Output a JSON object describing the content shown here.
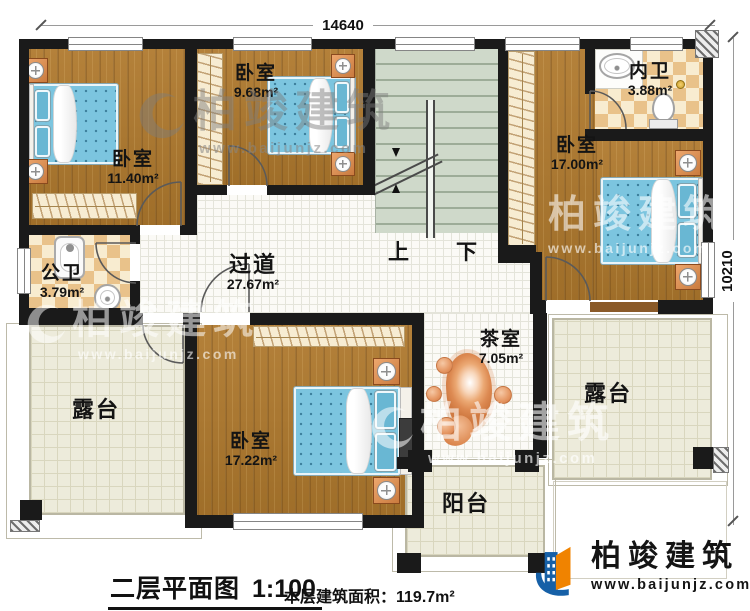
{
  "dimensions": {
    "width": "14640",
    "height": "10210"
  },
  "rooms": {
    "bedroom_tl": {
      "name": "卧室",
      "area": "11.40m²"
    },
    "bedroom_tm": {
      "name": "卧室",
      "area": "9.68m²"
    },
    "bedroom_right": {
      "name": "卧室",
      "area": "17.00m²"
    },
    "bedroom_bottom": {
      "name": "卧室",
      "area": "17.22m²"
    },
    "inner_bath": {
      "name": "内卫",
      "area": "3.88m²"
    },
    "public_bath": {
      "name": "公卫",
      "area": "3.79m²"
    },
    "hallway": {
      "name": "过道",
      "area": "27.67m²"
    },
    "tea_room": {
      "name": "茶室",
      "area": "7.05m²"
    },
    "terrace_left": {
      "name": "露台"
    },
    "terrace_right": {
      "name": "露台"
    },
    "balcony": {
      "name": "阳台"
    }
  },
  "stairs": {
    "up": "上",
    "down": "下"
  },
  "footer": {
    "title": "二层平面图",
    "scale": "1:100",
    "area_label": "本层建筑面积：",
    "area_value": "119.7m²"
  },
  "branding": {
    "company": "柏竣建筑",
    "website": "www.baijunjz.com"
  },
  "watermark": {
    "company": "柏竣建筑",
    "website": "www.baijunjz.com"
  },
  "colors": {
    "wall": "#1a1a1a",
    "wood": "#aa7932",
    "tile_checker_dark": "#e9c28a",
    "tile_checker_light": "#f8ecd0",
    "stair_green": "#cfd9ca",
    "terrace": "#edebdb",
    "bed_blue": "#7cc5df",
    "furniture_orange": "#e59662",
    "logo_blue": "#1660a7",
    "logo_orange": "#f08300"
  }
}
